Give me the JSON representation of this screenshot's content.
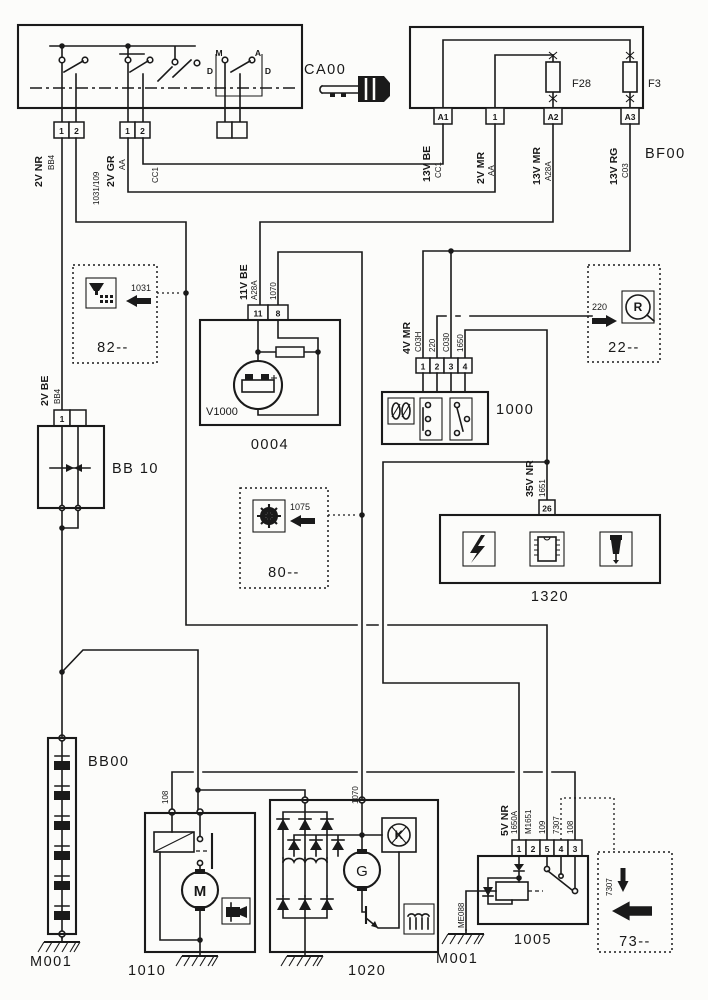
{
  "colors": {
    "ink": "#1a1a1a",
    "paper": "#fcfcfa"
  },
  "ignition": {
    "ref": "CA00",
    "letters": {
      "m": "M",
      "a": "A",
      "d_left": "D",
      "d_right": "D"
    },
    "conn_nr": {
      "p1": "1",
      "p2": "2"
    },
    "conn_gr": {
      "p1": "1",
      "p2": "2"
    }
  },
  "fusebox": {
    "ref": "BF00",
    "f28": "F28",
    "f3": "F3",
    "pin_a1": "A1",
    "pin_1": "1",
    "pin_a2": "A2",
    "pin_a3": "A3"
  },
  "wire_labels": {
    "v2nr": "2V NR",
    "bb4": "BB4",
    "n1031_109": "1031/109",
    "v2gr": "2V GR",
    "aa_ca": "AA",
    "cc1_ca": "CC1",
    "v13be": "13V BE",
    "cc1_bf": "CC1",
    "v2mr": "2V MR",
    "aa_bf": "AA",
    "v13mr": "13V MR",
    "a28a_bf": "A28A",
    "v13rg": "13V RG",
    "c03": "C03",
    "v11be": "11V BE",
    "a28a_04": "A28A",
    "n1070": "1070",
    "v4mr": "4V MR",
    "c03h": "C03H",
    "n220": "220",
    "c030": "C030",
    "n1650": "1650",
    "v35nr": "35V NR",
    "n1651": "1651",
    "v2be": "2V BE",
    "bb4_10": "BB4",
    "n108_1010": "108",
    "n1070_1020": "1070",
    "v5nr": "5V NR",
    "n1650a": "1650A",
    "m1651": "M1651",
    "n109": "109",
    "n7307": "7307",
    "n108": "108",
    "me088": "ME088"
  },
  "components": {
    "reg": {
      "ref": "V1000",
      "id": "0004",
      "pin11": "11",
      "pin8": "8"
    },
    "relay1000": {
      "id": "1000",
      "p1": "1",
      "p2": "2",
      "p3": "3",
      "p4": "4"
    },
    "ecu1320": {
      "id": "1320",
      "pin26": "26"
    },
    "bb10": {
      "id": "BB 10",
      "pin1": "1"
    },
    "bb00": {
      "id": "BB00"
    },
    "starter": {
      "id": "1010",
      "m": "M"
    },
    "alternator": {
      "id": "1020",
      "g": "G",
      "k": "K"
    },
    "relay1005": {
      "id": "1005",
      "p1": "1",
      "p2": "2",
      "p5": "5",
      "p4": "4",
      "p3": "3"
    },
    "gnd_left": "M001",
    "gnd_right": "M001"
  },
  "diagram_refs": {
    "d82": {
      "id": "82--",
      "wire": "1031"
    },
    "d22": {
      "id": "22--",
      "wire": "220",
      "icon_letter": "R"
    },
    "d80": {
      "id": "80--",
      "wire": "1075"
    },
    "d73": {
      "id": "73--",
      "wire": "7307"
    }
  }
}
